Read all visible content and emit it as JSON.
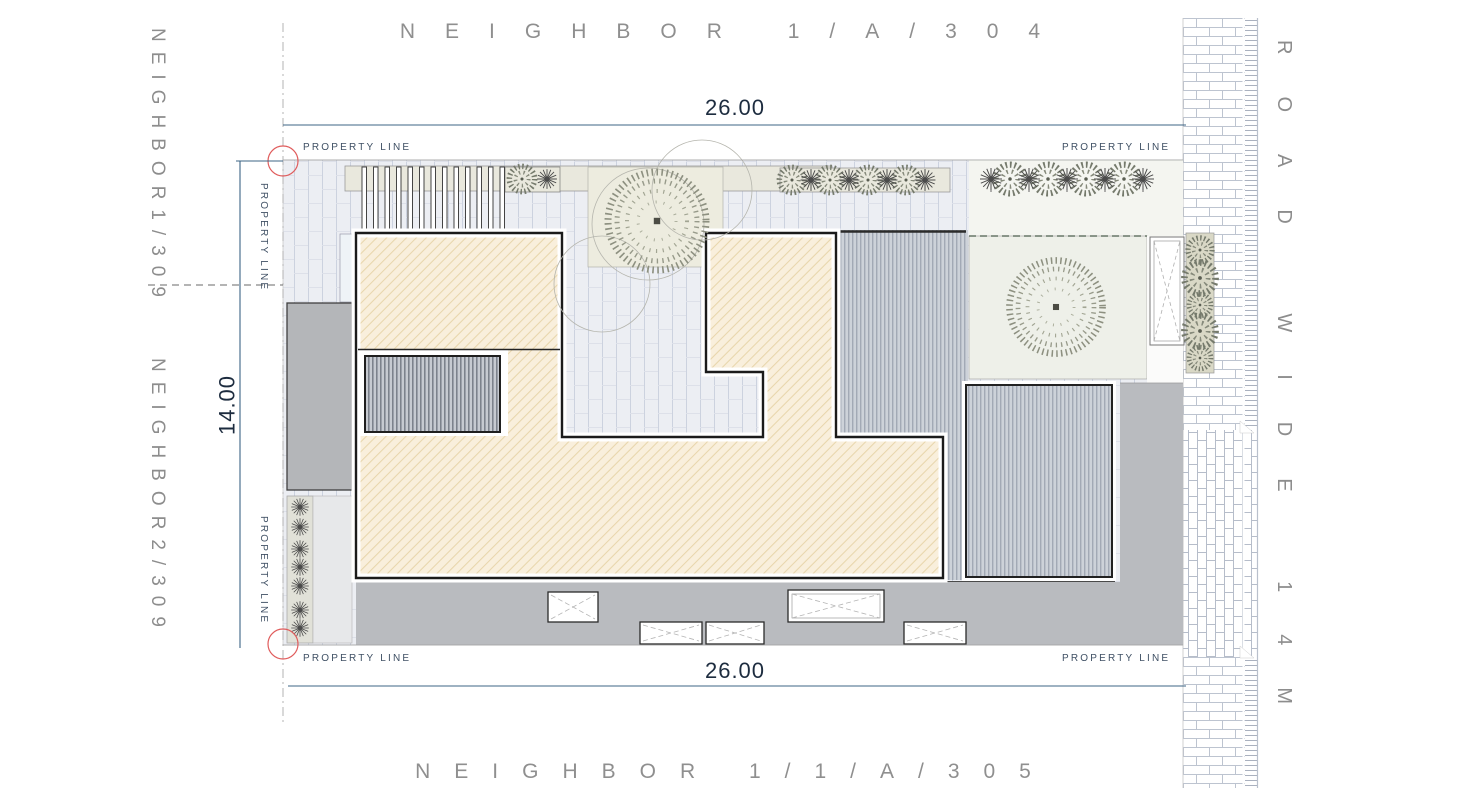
{
  "labels": {
    "neighbor_top": "NEIGHBOR 1/A/304",
    "neighbor_bottom": "NEIGHBOR 1/1/A/305",
    "neighbor_left_upper": "NEIGHBOR1/309",
    "neighbor_left_lower": "NEIGHBOR2/309",
    "road": "ROAD WIDE 14M",
    "property_line": "PROPERTY LINE"
  },
  "dimensions": {
    "plot_width_top": "26.00",
    "plot_width_bottom": "26.00",
    "plot_depth_left": "14.00"
  },
  "figures": {
    "tree_icon": "stippled-canopy-tree",
    "bush_icon": "round-shrub",
    "star_plant_icon": "spiky-plant",
    "skylight_icon": "crossed-rectangle",
    "pergola_icon": "slatted-louvers",
    "road_paving_icon": "brick-pattern"
  },
  "colors": {
    "building_fill": "#f9efdc",
    "building_outline": "#1b1b1b",
    "paving": "#eceef3",
    "deck": "#c9ced6",
    "driveway_gray": "#b9bbbf",
    "terrace_gray": "#b4b6b9",
    "garden": "#eef0e9",
    "planter_olive": "#d9d8c6",
    "dimension_blue": "#3c6486",
    "label_gray": "#8f8f8f",
    "property_text": "#3f5064",
    "marker_red": "#e05c5c"
  }
}
